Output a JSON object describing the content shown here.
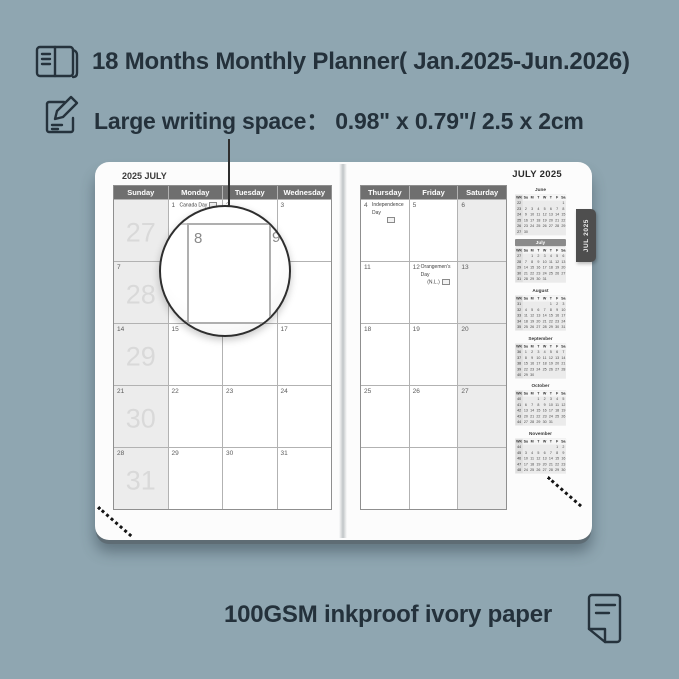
{
  "colors": {
    "background": "#8FA6B1",
    "ink": "#24313B",
    "header_bar": "#6F6F6F",
    "tab_bg": "#4E4E4E",
    "weekend_shade": "#ECECEC",
    "week_number_gray": "#D9D9D9",
    "page_white": "#FCFCFC"
  },
  "header": {
    "line1": "18 Months Monthly Planner( Jan.2025-Jun.2026)",
    "line2": "Large writing space：  0.98\" x 0.79\"/ 2.5 x 2cm"
  },
  "footer": {
    "text": "100GSM inkproof ivory paper"
  },
  "planner": {
    "left_page": {
      "title": "2025 JULY",
      "day_headers": [
        "Sunday",
        "Monday",
        "Tuesday",
        "Wednesday"
      ],
      "rows": [
        {
          "week": "27",
          "days": [
            {
              "d": ""
            },
            {
              "d": "1",
              "holiday": "Canada Day",
              "flag": "inline"
            },
            {
              "d": "2"
            },
            {
              "d": "3"
            }
          ]
        },
        {
          "week": "28",
          "days": [
            {
              "d": "7"
            },
            {
              "d": "8"
            },
            {
              "d": "9"
            },
            {
              "d": "10"
            }
          ]
        },
        {
          "week": "29",
          "days": [
            {
              "d": "14"
            },
            {
              "d": "15"
            },
            {
              "d": "16"
            },
            {
              "d": "17"
            }
          ]
        },
        {
          "week": "30",
          "days": [
            {
              "d": "21"
            },
            {
              "d": "22"
            },
            {
              "d": "23"
            },
            {
              "d": "24"
            }
          ]
        },
        {
          "week": "31",
          "days": [
            {
              "d": "28"
            },
            {
              "d": "29"
            },
            {
              "d": "30"
            },
            {
              "d": "31"
            }
          ]
        }
      ]
    },
    "right_page": {
      "title": "JULY 2025",
      "day_headers": [
        "Thursday",
        "Friday",
        "Saturday"
      ],
      "rows": [
        {
          "days": [
            {
              "d": "4",
              "holiday": "Independence Day",
              "flag": "below"
            },
            {
              "d": "5"
            },
            {
              "d": "6"
            }
          ]
        },
        {
          "days": [
            {
              "d": "11"
            },
            {
              "d": "12",
              "holiday": "Orangemen's Day",
              "holiday2": "(N.L.)",
              "flag": "line2"
            },
            {
              "d": "13"
            }
          ]
        },
        {
          "days": [
            {
              "d": "18"
            },
            {
              "d": "19"
            },
            {
              "d": "20"
            }
          ]
        },
        {
          "days": [
            {
              "d": "25"
            },
            {
              "d": "26"
            },
            {
              "d": "27"
            }
          ]
        },
        {
          "days": [
            {
              "d": ""
            },
            {
              "d": ""
            },
            {
              "d": ""
            }
          ]
        }
      ]
    },
    "tab": "JUL 2025",
    "magnifier": {
      "day_a": "8",
      "day_b": "9"
    },
    "mini_header": [
      "WK",
      "Su",
      "M",
      "T",
      "W",
      "T",
      "F",
      "Sa"
    ],
    "mini_calendars": [
      {
        "month": "June",
        "current": false,
        "rows": [
          [
            "22",
            "",
            "",
            "",
            "",
            "",
            "",
            "1"
          ],
          [
            "23",
            "2",
            "3",
            "4",
            "5",
            "6",
            "7",
            "8"
          ],
          [
            "24",
            "9",
            "10",
            "11",
            "12",
            "13",
            "14",
            "15"
          ],
          [
            "25",
            "16",
            "17",
            "18",
            "19",
            "20",
            "21",
            "22"
          ],
          [
            "26",
            "23",
            "24",
            "25",
            "26",
            "27",
            "28",
            "29"
          ],
          [
            "27",
            "30",
            "",
            "",
            "",
            "",
            "",
            ""
          ]
        ]
      },
      {
        "month": "July",
        "current": true,
        "rows": [
          [
            "27",
            "",
            "1",
            "2",
            "3",
            "4",
            "5",
            "6"
          ],
          [
            "28",
            "7",
            "8",
            "9",
            "10",
            "11",
            "12",
            "13"
          ],
          [
            "29",
            "14",
            "15",
            "16",
            "17",
            "18",
            "19",
            "20"
          ],
          [
            "30",
            "21",
            "22",
            "23",
            "24",
            "25",
            "26",
            "27"
          ],
          [
            "31",
            "28",
            "29",
            "30",
            "31",
            "",
            "",
            ""
          ]
        ]
      },
      {
        "month": "August",
        "current": false,
        "rows": [
          [
            "31",
            "",
            "",
            "",
            "",
            "1",
            "2",
            "3"
          ],
          [
            "32",
            "4",
            "5",
            "6",
            "7",
            "8",
            "9",
            "10"
          ],
          [
            "33",
            "11",
            "12",
            "13",
            "14",
            "15",
            "16",
            "17"
          ],
          [
            "34",
            "18",
            "19",
            "20",
            "21",
            "22",
            "23",
            "24"
          ],
          [
            "35",
            "25",
            "26",
            "27",
            "28",
            "29",
            "30",
            "31"
          ]
        ]
      },
      {
        "month": "September",
        "current": false,
        "rows": [
          [
            "36",
            "1",
            "2",
            "3",
            "4",
            "5",
            "6",
            "7"
          ],
          [
            "37",
            "8",
            "9",
            "10",
            "11",
            "12",
            "13",
            "14"
          ],
          [
            "38",
            "15",
            "16",
            "17",
            "18",
            "19",
            "20",
            "21"
          ],
          [
            "39",
            "22",
            "23",
            "24",
            "25",
            "26",
            "27",
            "28"
          ],
          [
            "40",
            "29",
            "30",
            "",
            "",
            "",
            "",
            ""
          ]
        ]
      },
      {
        "month": "October",
        "current": false,
        "rows": [
          [
            "40",
            "",
            "",
            "1",
            "2",
            "3",
            "4",
            "5"
          ],
          [
            "41",
            "6",
            "7",
            "8",
            "9",
            "10",
            "11",
            "12"
          ],
          [
            "42",
            "13",
            "14",
            "15",
            "16",
            "17",
            "18",
            "19"
          ],
          [
            "43",
            "20",
            "21",
            "22",
            "23",
            "24",
            "25",
            "26"
          ],
          [
            "44",
            "27",
            "28",
            "29",
            "30",
            "31",
            "",
            ""
          ]
        ]
      },
      {
        "month": "November",
        "current": false,
        "rows": [
          [
            "44",
            "",
            "",
            "",
            "",
            "",
            "1",
            "2"
          ],
          [
            "45",
            "3",
            "4",
            "5",
            "6",
            "7",
            "8",
            "9"
          ],
          [
            "46",
            "10",
            "11",
            "12",
            "13",
            "14",
            "15",
            "16"
          ],
          [
            "47",
            "17",
            "18",
            "19",
            "20",
            "21",
            "22",
            "23"
          ],
          [
            "48",
            "24",
            "25",
            "26",
            "27",
            "28",
            "29",
            "30"
          ]
        ]
      }
    ]
  }
}
